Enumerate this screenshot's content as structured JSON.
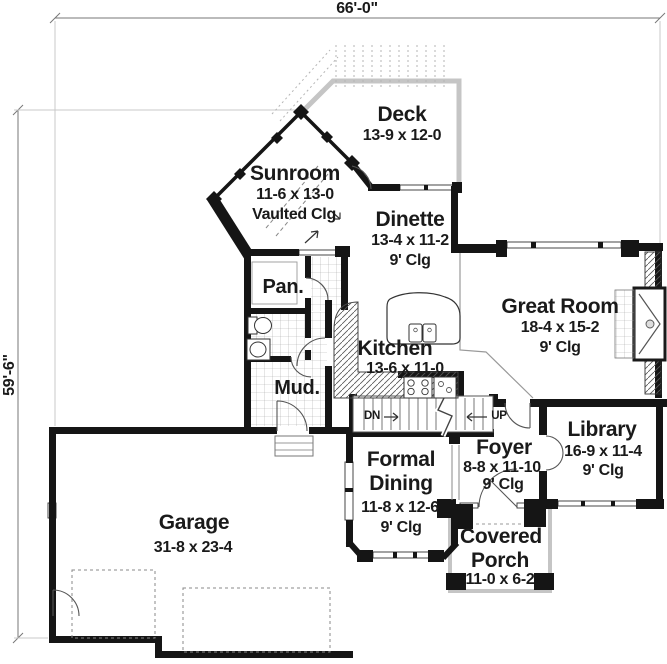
{
  "drawing": {
    "type": "first-floor-plan",
    "overall_width": "66'-0\"",
    "overall_depth": "59'-6\""
  },
  "rooms": {
    "deck": {
      "name": "Deck",
      "size": "13-9 x 12-0"
    },
    "sunroom": {
      "name": "Sunroom",
      "size": "11-6 x 13-0",
      "ceiling": "Vaulted Clg"
    },
    "dinette": {
      "name": "Dinette",
      "size": "13-4 x 11-2",
      "ceiling": "9' Clg"
    },
    "great_room": {
      "name": "Great Room",
      "size": "18-4 x 15-2",
      "ceiling": "9' Clg"
    },
    "pantry": {
      "name": "Pan."
    },
    "kitchen": {
      "name": "Kitchen",
      "size": "13-6 x 11-0"
    },
    "mud_room": {
      "name": "Mud."
    },
    "foyer": {
      "name": "Foyer",
      "size": "8-8 x 11-10",
      "ceiling": "9' Clg"
    },
    "library": {
      "name": "Library",
      "size": "16-9 x 11-4",
      "ceiling": "9' Clg"
    },
    "formal_dining": {
      "name_line1": "Formal",
      "name_line2": "Dining",
      "size": "11-8 x 12-6",
      "ceiling": "9' Clg"
    },
    "garage": {
      "name": "Garage",
      "size": "31-8 x 23-4"
    },
    "covered_porch": {
      "name_line1": "Covered",
      "name_line2": "Porch",
      "size": "11-0 x 6-2"
    }
  },
  "stairs": {
    "down": "DN",
    "up": "UP"
  },
  "colors": {
    "wall": "#151515",
    "deck_outline": "#c5c5c5",
    "dim_line": "#777777",
    "tile_line": "#aaaaaa",
    "text": "#1a1a1a"
  }
}
